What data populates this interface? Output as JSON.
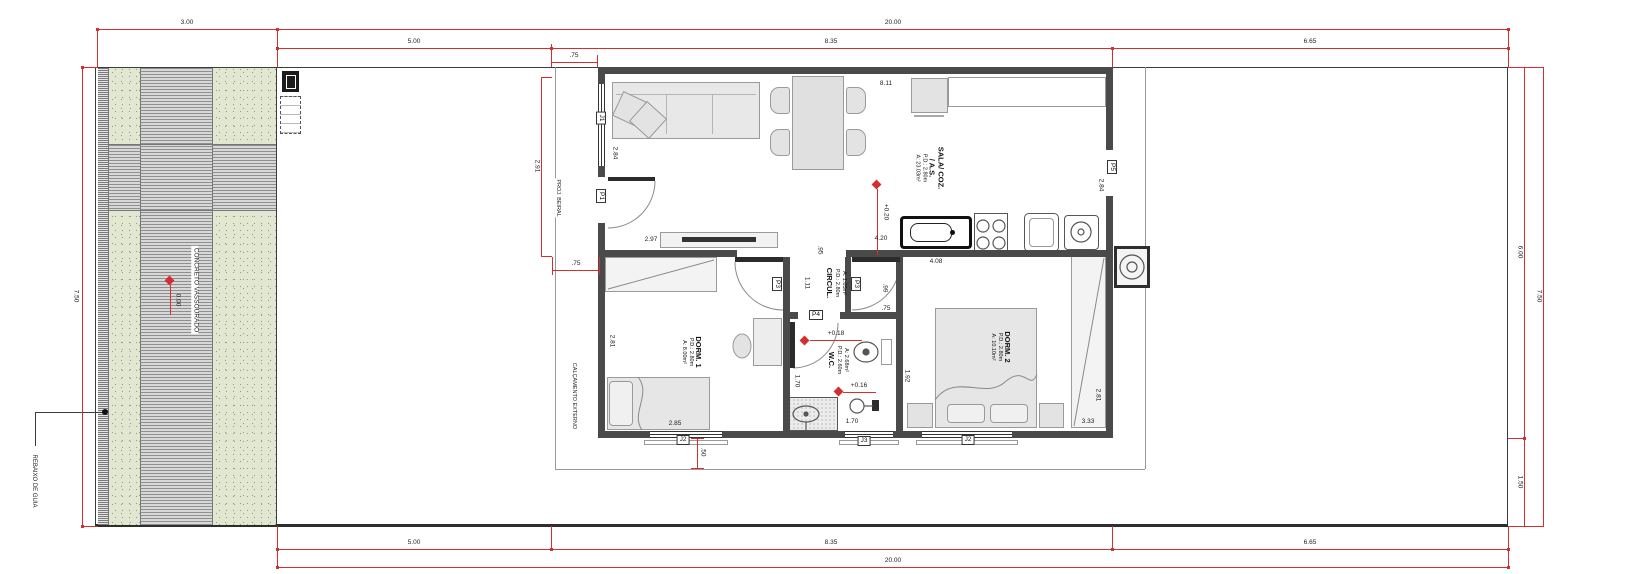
{
  "drawing": {
    "perimeter_dims": {
      "top_3": "3.00",
      "top_20": "20.00",
      "top_5": "5.00",
      "top_835": "8.35",
      "top_665": "6.65",
      "bottom_5": "5.00",
      "bottom_835": "8.35",
      "bottom_665": "6.65",
      "bottom_20": "20.00",
      "left_750": "7.50",
      "right_600": "6.00",
      "right_750": "7.50",
      "right_150": "1.50"
    },
    "detail_dims": {
      "d291": "2.91",
      "d75_top": ".75",
      "d75_mid": ".75",
      "d75_wc": ".75",
      "d284_l": "2.84",
      "d284_r": "2.84",
      "d297": "2.97",
      "d811": "8.11",
      "d420": "4.20",
      "d408": "4.08",
      "d95": ".95",
      "d111": "1.11",
      "d99": ".99",
      "d285": "2.85",
      "d281_l": "2.81",
      "d281_r": "2.81",
      "d170_v": "1.70",
      "d170_h": "1.70",
      "d192": "1.92",
      "d333": "3.33",
      "d50": ".50"
    },
    "rooms": {
      "sala": {
        "name": "SALA/ COZ.",
        "name2": "/ A.S.",
        "pd": "P.D.: 2.80m",
        "area": "A: 23.03m²"
      },
      "circul": {
        "name": "CIRCUL.",
        "pd": "P.D.: 2.80m",
        "area": "A: 1.05m²"
      },
      "wc": {
        "name": "W.C.",
        "pd": "P.D.: 2.60m",
        "area": "A: 2.68m²"
      },
      "dorm1": {
        "name": "DORM. 1",
        "pd": "P.D.: 2.80m",
        "area": "A: 8.00m²"
      },
      "dorm2": {
        "name": "DORM. 2",
        "pd": "P.D.: 2.80m",
        "area": "A: 10.10m²"
      }
    },
    "levels": {
      "driveway": "0.00",
      "sala": "+0.20",
      "wc_entry": "+0.18",
      "wc_shower": "+0.16"
    },
    "openings": {
      "j1": "J1",
      "j2_dorm1": "J2",
      "j3": "J3",
      "j2_dorm2": "J2",
      "p1": "P1",
      "p3_dorm1": "P3",
      "p3_dorm2": "P3",
      "p4": "P4",
      "p5": "P5"
    },
    "annotations": {
      "concreto": "CONCRETO VASSOURADO",
      "calcamento": "CALÇAMENTO EXTERNO",
      "rebaixo": "REBAIXO DE GUIA",
      "beiral": "PROJ. BEIRAL"
    },
    "colors": {
      "dimension_red": "#d23030",
      "wall_gray": "#4a4a4a",
      "lawn_green": "#e2e7d2"
    }
  }
}
